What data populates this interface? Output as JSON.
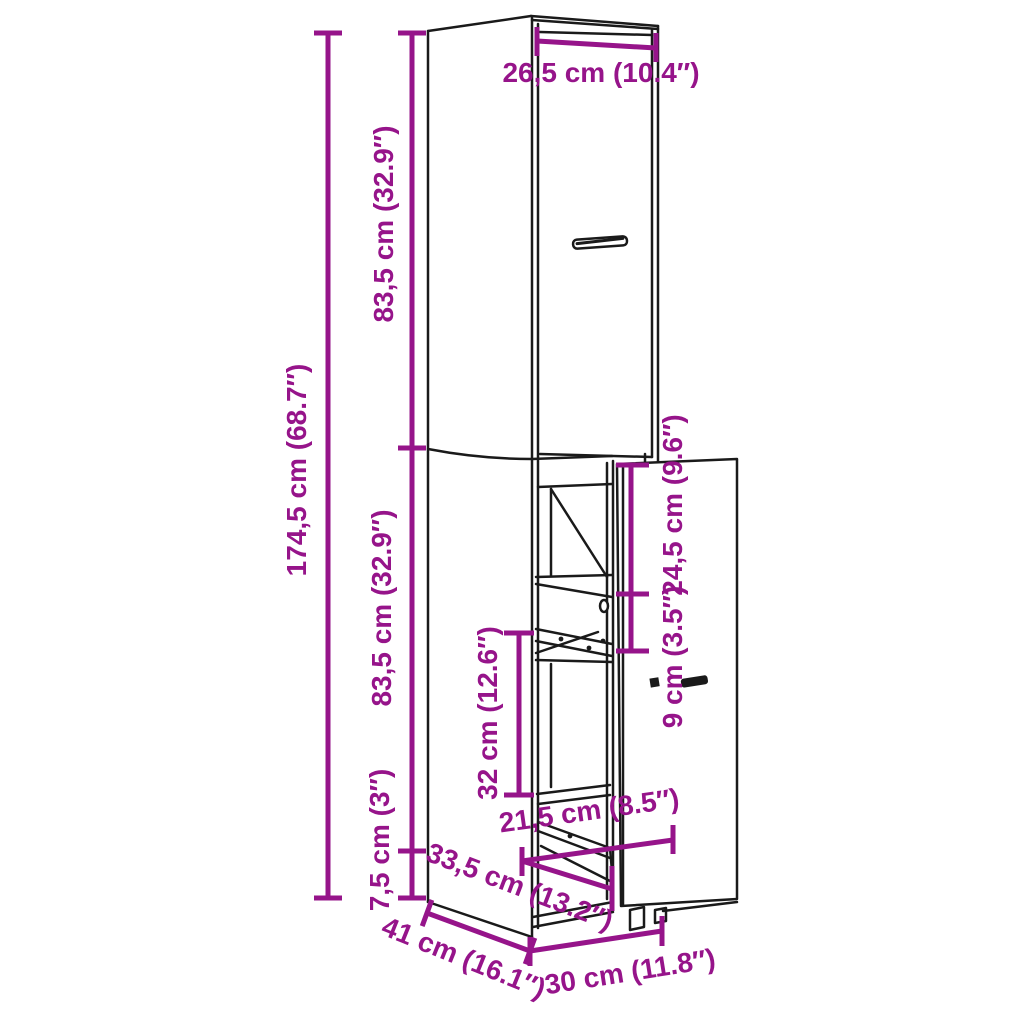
{
  "colors": {
    "dimension_color": "#96148A",
    "line_color": "#1A1A1A",
    "background": "#FFFFFF"
  },
  "dimensions": {
    "door_width": "26,5 cm (10.4″)",
    "total_height": "174,5 cm (68.7″)",
    "upper_section_height": "83,5 cm (32.9″)",
    "lower_section_height": "83,5 cm (32.9″)",
    "plinth_height": "7,5 cm (3″)",
    "top_compartment_height": "24,5 cm (9.6″)",
    "drawer_front_height": "9 cm (3.5″)",
    "middle_compartment_height": "32 cm (12.6″)",
    "drawer_width": "21,5 cm (8.5″)",
    "drawer_depth": "33,5 cm (13.2″)",
    "total_depth": "41 cm (16.1″)",
    "total_width": "30 cm (11.8″)"
  }
}
